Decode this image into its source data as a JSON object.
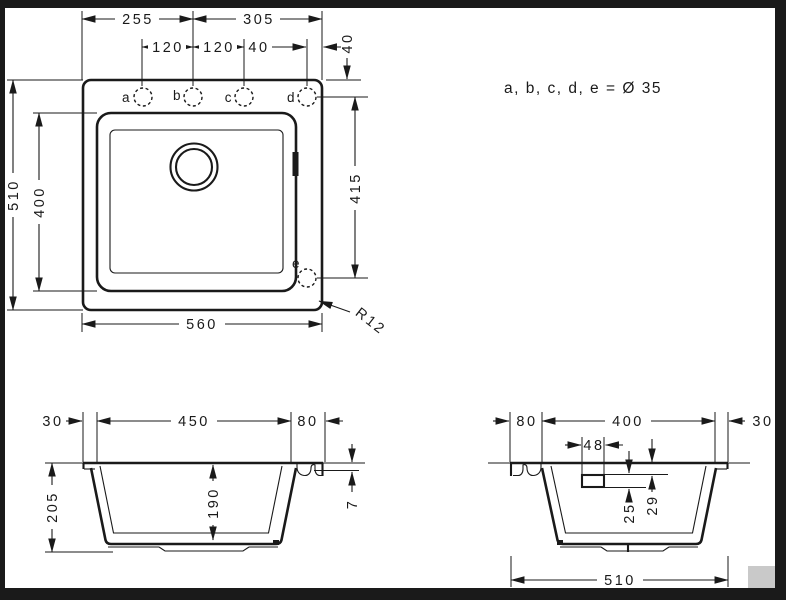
{
  "top": {
    "d255": "255",
    "d305": "305",
    "d120a": "120",
    "d120b": "120",
    "d40h": "40",
    "d40v": "40",
    "d510": "510",
    "d400": "400",
    "d415": "415",
    "d560": "560",
    "r12": "R12",
    "a": "a",
    "b": "b",
    "c": "c",
    "d": "d",
    "e": "e",
    "note": "a, b, c, d, e = Ø 35"
  },
  "front": {
    "d30": "30",
    "d450": "450",
    "d80": "80",
    "d205": "205",
    "d190": "190",
    "d7": "7"
  },
  "side": {
    "d80": "80",
    "d400": "400",
    "d30": "30",
    "d48": "48",
    "d25": "25",
    "d29": "29",
    "d510": "510"
  }
}
